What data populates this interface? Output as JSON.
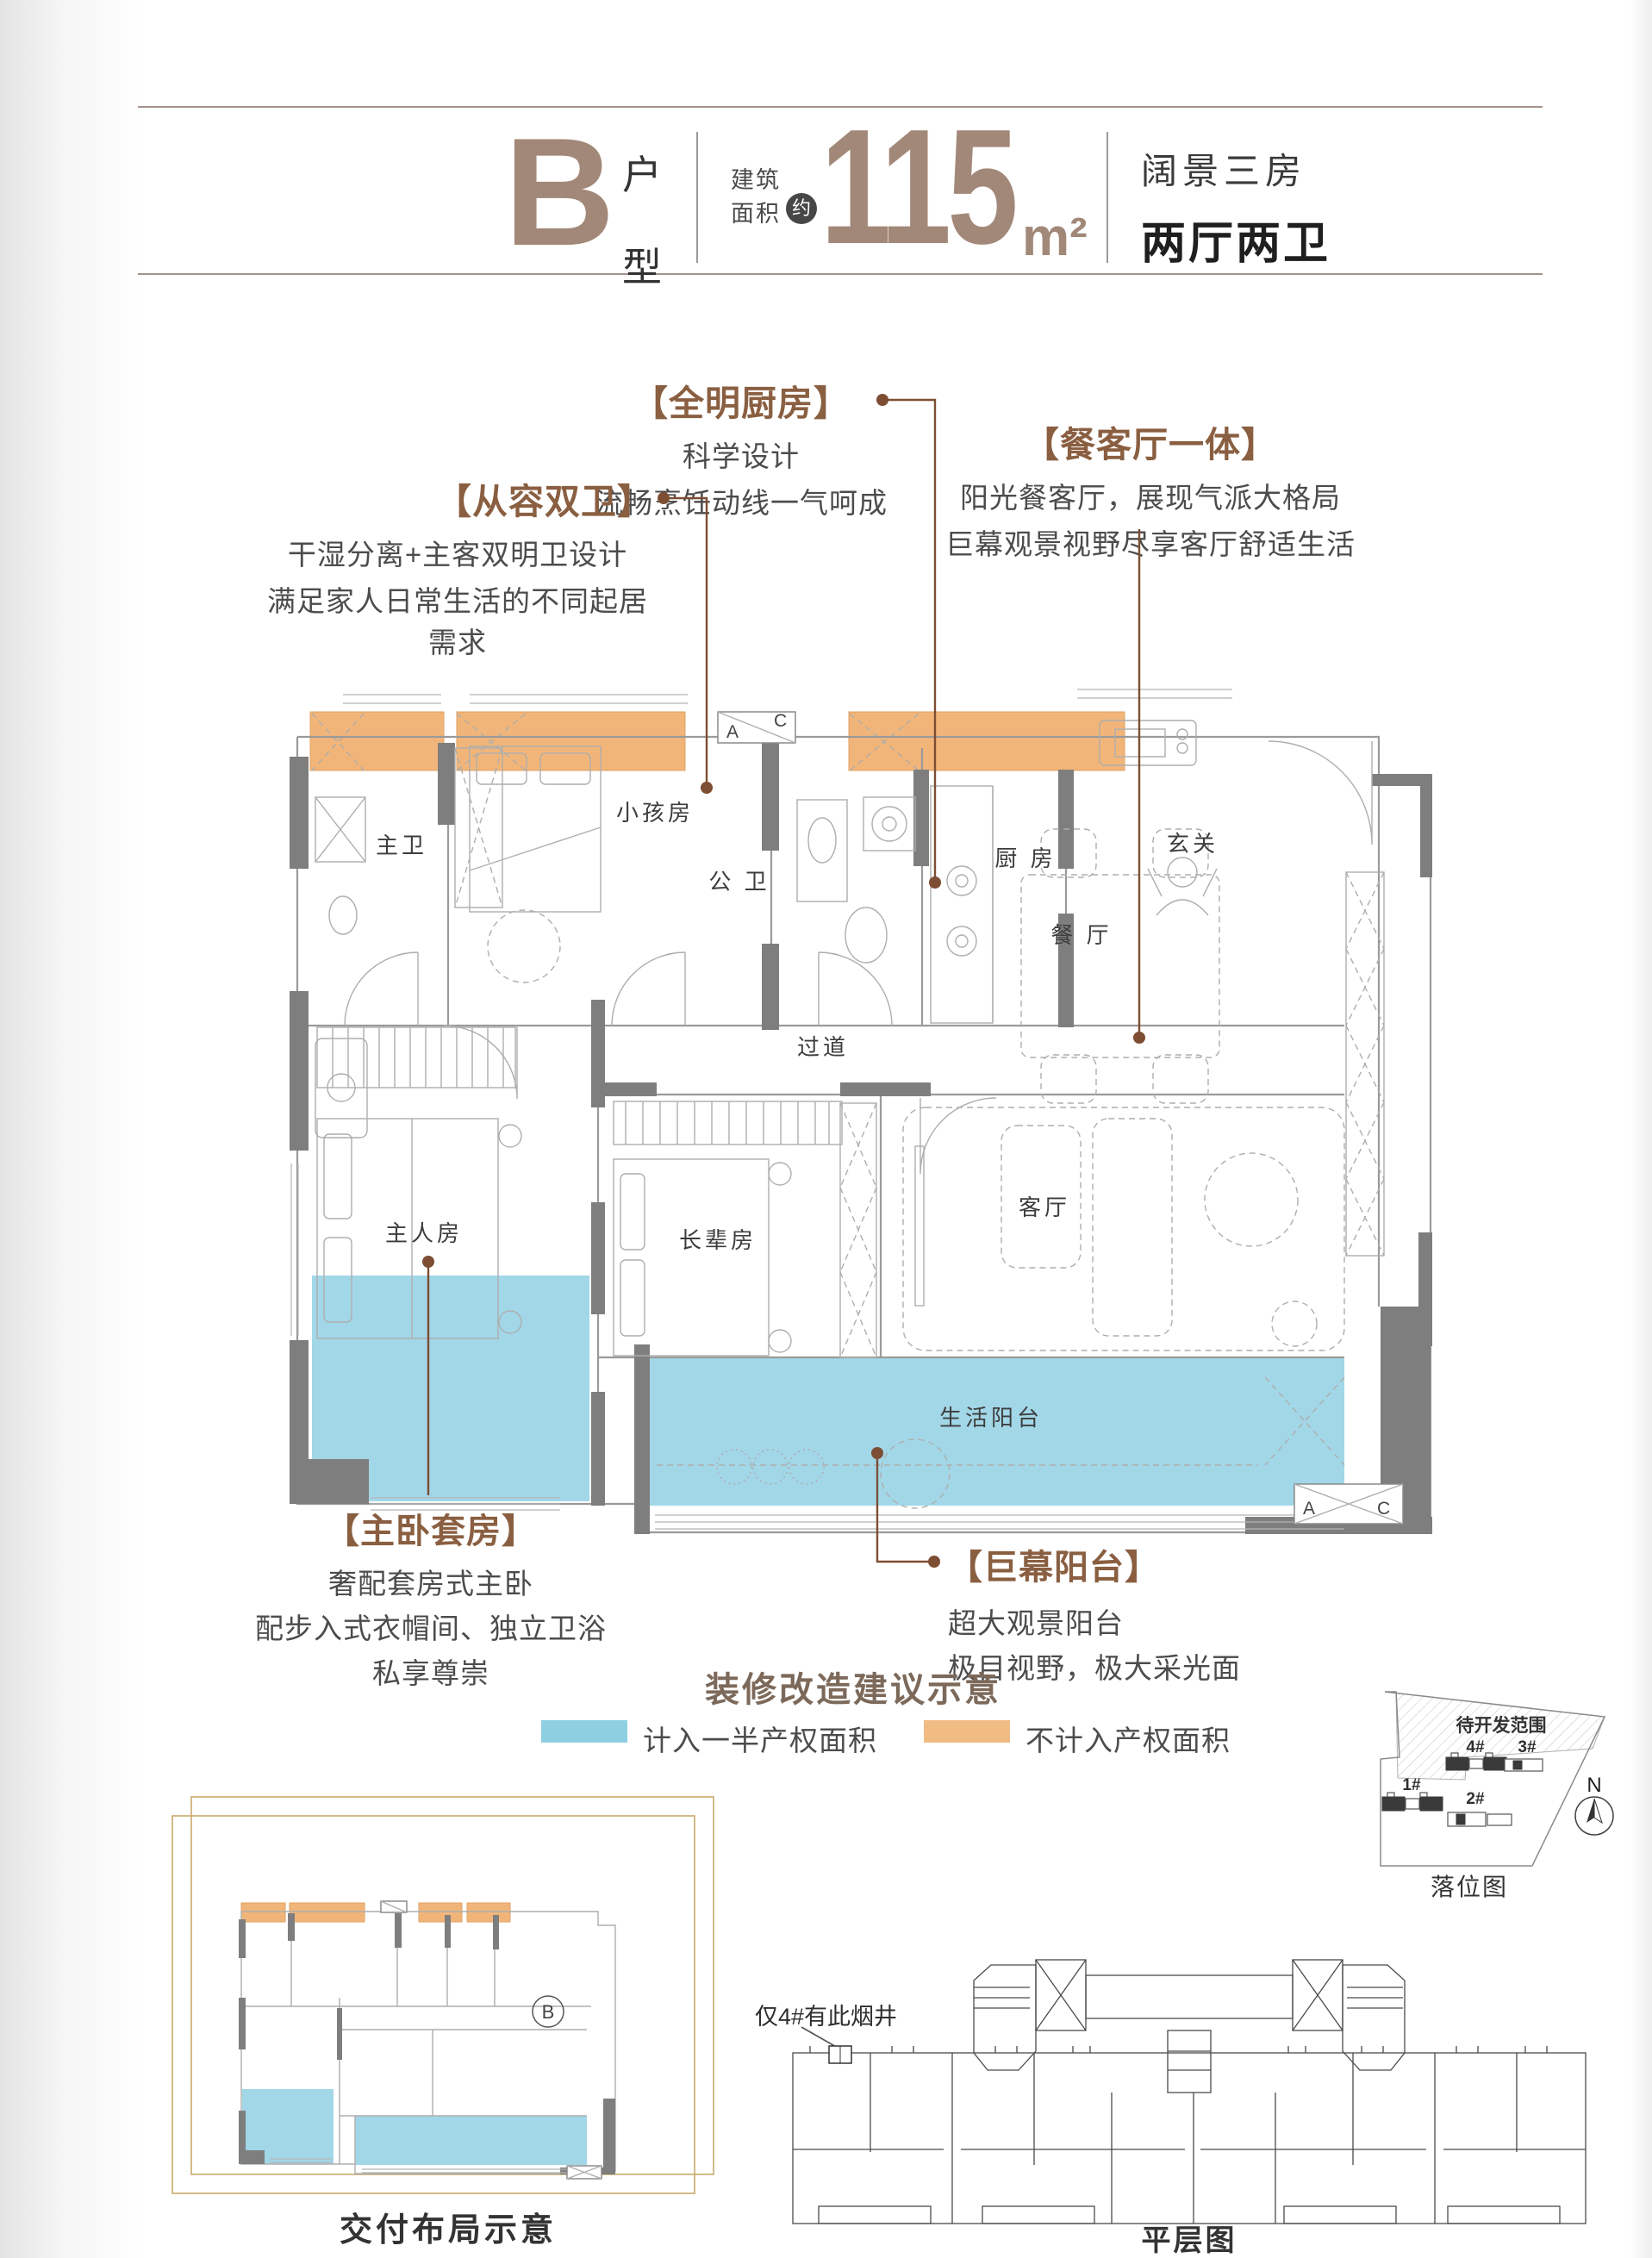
{
  "header": {
    "unit": "B",
    "unit_suffix": "户型",
    "area_label": "建筑面积",
    "area_approx": "约",
    "area_value": "115",
    "area_unit": "m²",
    "desc_line1": "阔景三房",
    "desc_line2": "两厅两卫"
  },
  "annotations": {
    "kitchen": {
      "title": "【全明厨房】",
      "line1": "科学设计",
      "line2": "流畅烹饪动线一气呵成"
    },
    "dining": {
      "title": "【餐客厅一体】",
      "line1": "阳光餐客厅，展现气派大格局",
      "line2": "巨幕观景视野尽享客厅舒适生活"
    },
    "baths": {
      "title": "【从容双卫】",
      "line1": "干湿分离+主客双明卫设计",
      "line2": "满足家人日常生活的不同起居需求"
    },
    "master": {
      "title": "【主卧套房】",
      "line1": "奢配套房式主卧",
      "line2": "配步入式衣帽间、独立卫浴",
      "line3": "私享尊崇"
    },
    "balcony": {
      "title": "【巨幕阳台】",
      "line1": "超大观景阳台",
      "line2": "极目视野，极大采光面"
    }
  },
  "plan": {
    "rooms": {
      "master_bath": "主卫",
      "kids_room": "小孩房",
      "public_bath": "公 卫",
      "kitchen": "厨 房",
      "foyer": "玄关",
      "dining": "餐 厅",
      "hallway": "过道",
      "master_room": "主人房",
      "elder_room": "长辈房",
      "living": "客厅",
      "life_balcony": "生活阳台"
    },
    "ac": {
      "a": "A",
      "c": "C"
    }
  },
  "legend": {
    "title": "装修改造建议示意",
    "half_property": "计入一半产权面积",
    "no_property": "不计入产权面积"
  },
  "mini_plan": {
    "caption": "交付布局示意",
    "unit_label": "B"
  },
  "site_plan": {
    "area_label": "待开发范围",
    "b1": "1#",
    "b2": "2#",
    "b3": "3#",
    "b4": "4#",
    "north": "N",
    "caption": "落位图"
  },
  "floor_layout": {
    "note": "仅4#有此烟井",
    "caption": "平层图"
  },
  "colors": {
    "brand_brown": "#a28878",
    "annotation_brown": "#8a5f41",
    "leader_brown": "#7d4e33",
    "plan_blue": "#a2d7e8",
    "plan_orange": "#f2b579",
    "wall_gray": "#7e7e7e",
    "legend_blue": "#8ed0e2",
    "legend_orange": "#f0bc84",
    "frame_gold": "#c9aa6d"
  }
}
